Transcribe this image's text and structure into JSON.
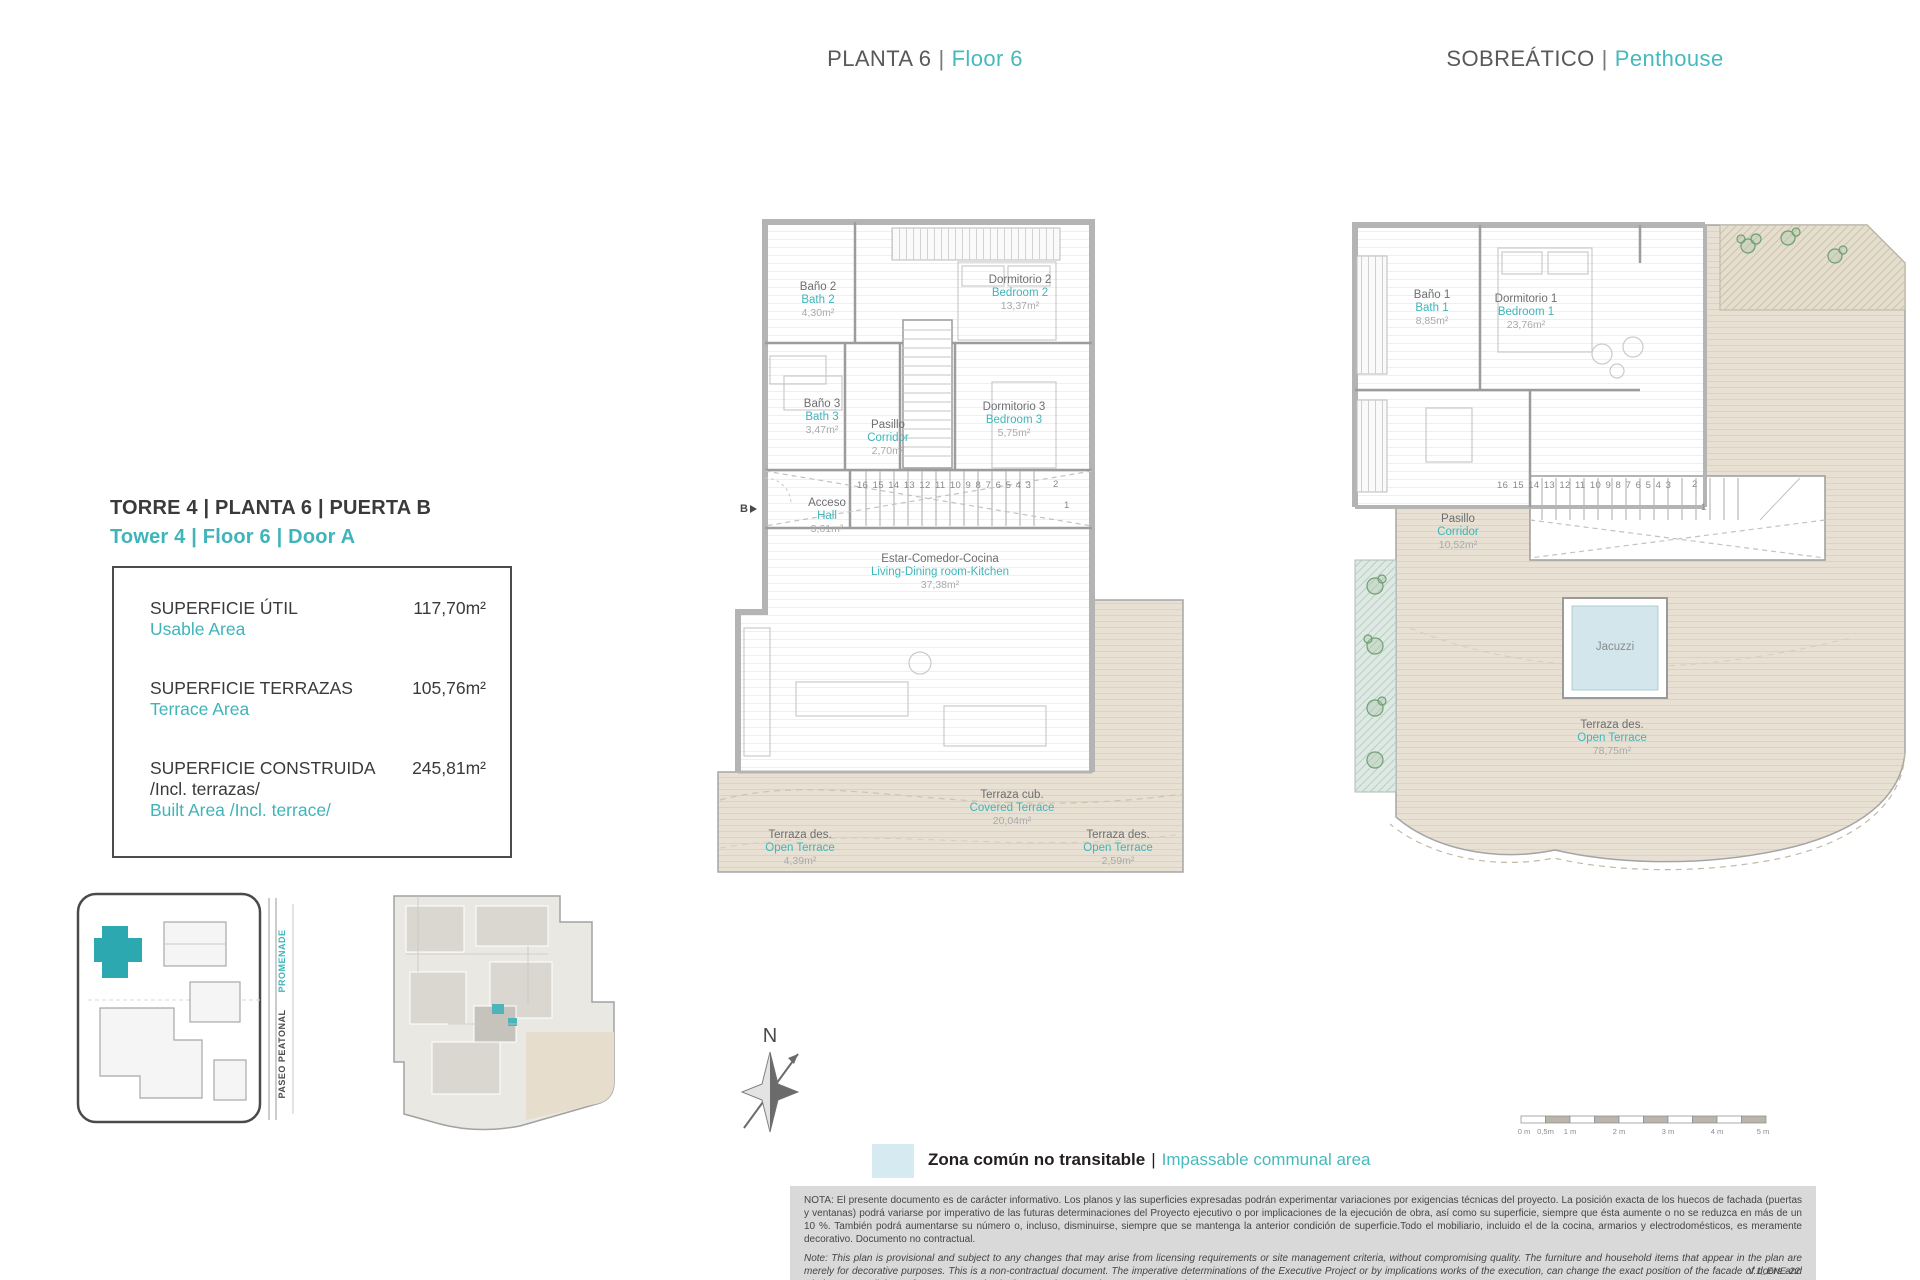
{
  "accent": "#45b9bd",
  "header": {
    "sep": "|",
    "floor6": {
      "es": "PLANTA 6",
      "en": "Floor 6"
    },
    "penthouse": {
      "es": "SOBREÁTICO",
      "en": "Penthouse"
    }
  },
  "unit_info": {
    "title_es": "TORRE 4 | PLANTA 6 | PUERTA B",
    "title_en": "Tower 4 | Floor 6 | Door A",
    "rows": [
      {
        "label_es": "SUPERFICIE ÚTIL",
        "label_en": "Usable Area",
        "value": "117,70m²"
      },
      {
        "label_es": "SUPERFICIE TERRAZAS",
        "label_en": "Terrace Area",
        "value": "105,76m²"
      },
      {
        "label_es": "SUPERFICIE CONSTRUIDA",
        "label_es2": "/Incl. terrazas/",
        "label_en": "Built Area /Incl. terrace/",
        "value": "245,81m²"
      }
    ]
  },
  "floor6_plan": {
    "entry": "B",
    "stairs": "16 15 14 13 12 11 10 9 8 7 6 5 4 3",
    "stair_2": "2",
    "stair_1": "1",
    "rooms": [
      {
        "es": "Baño 2",
        "en": "Bath 2",
        "area": "4,30m²"
      },
      {
        "es": "Dormitorio 2",
        "en": "Bedroom 2",
        "area": "13,37m²"
      },
      {
        "es": "Baño 3",
        "en": "Bath 3",
        "area": "3,47m²"
      },
      {
        "es": "Pasillo",
        "en": "Corridor",
        "area": "2,70m²"
      },
      {
        "es": "Dormitorio 3",
        "en": "Bedroom 3",
        "area": "5,75m²"
      },
      {
        "es": "Acceso",
        "en": "Hall",
        "area": "3,61m²"
      },
      {
        "es": "Estar-Comedor-Cocina",
        "en": "Living-Dining room-Kitchen",
        "area": "37,38m²"
      },
      {
        "es": "Terraza cub.",
        "en": "Covered Terrace",
        "area": "20,04m²"
      },
      {
        "es": "Terraza des.",
        "en": "Open Terrace",
        "area": "4,39m²"
      },
      {
        "es": "Terraza des.",
        "en": "Open Terrace",
        "area": "2,59m²"
      }
    ]
  },
  "penthouse_plan": {
    "stairs": "16 15 14 13 12 11 10 9 8 7 6 5 4 3",
    "stair_2": "2",
    "stair_1": "1",
    "jacuzzi": "Jacuzzi",
    "rooms": [
      {
        "es": "Baño 1",
        "en": "Bath 1",
        "area": "8,85m²"
      },
      {
        "es": "Dormitorio 1",
        "en": "Bedroom 1",
        "area": "23,76m²"
      },
      {
        "es": "Pasillo",
        "en": "Corridor",
        "area": "10,52m²"
      },
      {
        "es": "Terraza des.",
        "en": "Open Terrace",
        "area": "78,75m²"
      }
    ]
  },
  "site_plan": {
    "promenade": "PROMENADE",
    "paseo": "PASEO PEATONAL"
  },
  "compass": {
    "north": "N"
  },
  "legend": {
    "label_es": "Zona común no transitable",
    "sep": "|",
    "label_en": "Impassable communal area"
  },
  "scale_bar": {
    "ticks": [
      "0 m",
      "0,5m",
      "1 m",
      "2 m",
      "3 m",
      "4 m",
      "5 m"
    ]
  },
  "note": {
    "es": "NOTA:  El presente documento es de carácter informativo. Los planos y las superficies expresadas podrán experimentar variaciones por exigencias técnicas del proyecto. La posición exacta de los huecos de fachada (puertas y ventanas) podrá variarse por imperativo de las futuras determinaciones del Proyecto ejecutivo o por implicaciones de la ejecución de obra, así como su superficie, siempre que ésta aumente o no se reduzca en más de un 10 %. También podrá aumentarse su número o, incluso, disminuirse, siempre que se mantenga la anterior condición de superficie.Todo el mobiliario, incluido el de la cocina, armarios y electrodomésticos, es meramente decorativo. Documento no contractual.",
    "en": "Note: This plan is provisional and subject to any changes that may arise from licensing requirements or site management criteria, without compromising quality. The furniture and household items that appear in the plan are merely for decorative purposes. This is a non-contractual document. The imperative determinations of the Executive Project or by implications works of the execution, can change the exact position of the facade of doors and windows, as well the surface area may also be increased or even decrease not more than a 10%.",
    "version": "V.1_ENE-22"
  }
}
